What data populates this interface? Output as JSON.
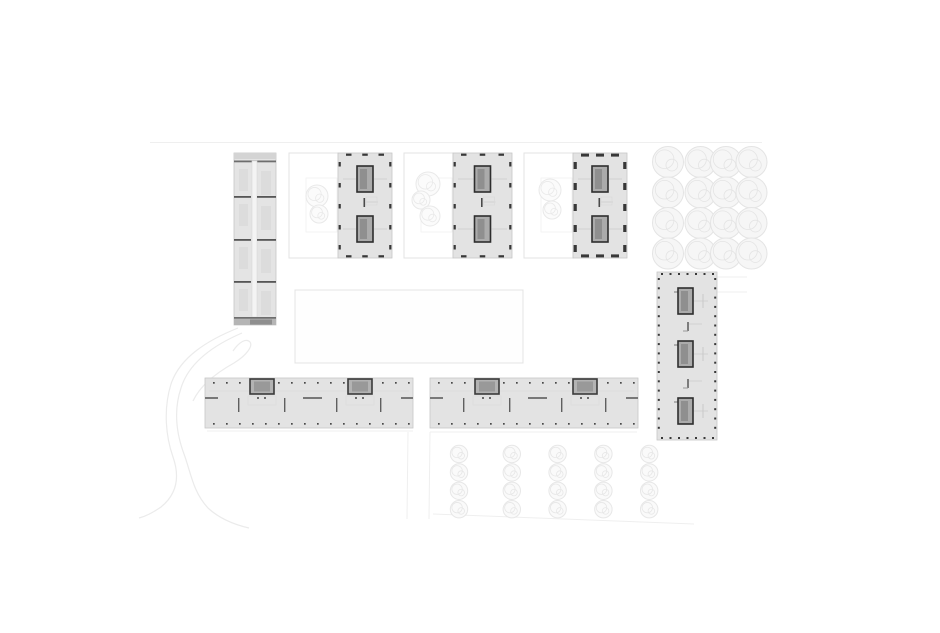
{
  "canvas": {
    "width": 940,
    "height": 633,
    "background": "#ffffff"
  },
  "palette": {
    "building_fill": "#e3e3e3",
    "building_stroke": "#c7c7c7",
    "slab_fill": "#e4e4e4",
    "core_fill": "#ababab",
    "core_shaft": "#8f8f8f",
    "core_stroke": "#2e2e2e",
    "tick_dark": "#383838",
    "divider_dark": "#565656",
    "faint_line": "#efefef",
    "walkway_stroke": "#ebebeb",
    "courtyard_stroke": "#e3e3e3",
    "courtyard_inner_stroke": "#f1f1f1",
    "tree_stroke_big": "#e4e4e4",
    "tree_fill_big": "#f6f6f6",
    "tree_stroke_small": "#e7e7e7",
    "tree_fill_small": "#fafafa",
    "detail_faint": "#cfcfcf",
    "dash_gray": "#787878",
    "stub_gray": "#5f5f5f"
  },
  "site_lines": [
    {
      "x1": 150,
      "y1": 142.5,
      "x2": 762,
      "y2": 142.5,
      "w": 1
    },
    {
      "x1": 207,
      "y1": 431,
      "x2": 413,
      "y2": 431,
      "w": 1
    },
    {
      "x1": 430,
      "y1": 432,
      "x2": 637,
      "y2": 432,
      "w": 1
    },
    {
      "x1": 408,
      "y1": 432,
      "x2": 407,
      "y2": 519,
      "w": 1
    },
    {
      "x1": 430,
      "y1": 432,
      "x2": 429,
      "y2": 519,
      "w": 1
    },
    {
      "x1": 433,
      "y1": 514,
      "x2": 694,
      "y2": 524,
      "w": 1
    },
    {
      "x1": 717,
      "y1": 277,
      "x2": 747,
      "y2": 277,
      "w": 1
    },
    {
      "x1": 717,
      "y1": 292,
      "x2": 747,
      "y2": 292,
      "w": 1
    }
  ],
  "walkway_paths": [
    "M238,328 C208,340 180,357 171,384 C163,410 166,437 173,457 C180,477 177,494 161,507 C151,514 143,517 139,518",
    "M242,333 C214,345 189,362 181,388 C173,412 177,435 184,454 C191,473 193,492 208,508 C221,520 236,525 249,528",
    "M233,351 C239,342 246,338 250,342 C253,346 247,355 234,363 C216,373 200,386 193,401"
  ],
  "lawn_rect": {
    "x": 295,
    "y": 290,
    "w": 228,
    "h": 73
  },
  "courtyards": [
    {
      "x": 289,
      "y": 153,
      "w": 49,
      "h": 105,
      "inner": {
        "x": 306,
        "y": 178,
        "w": 31,
        "h": 54
      },
      "trees": [
        {
          "cx": 317,
          "cy": 196,
          "r": 11
        },
        {
          "cx": 319,
          "cy": 214,
          "r": 9
        }
      ]
    },
    {
      "x": 404,
      "y": 153,
      "w": 49,
      "h": 105,
      "inner": {
        "x": 421,
        "y": 178,
        "w": 31,
        "h": 54
      },
      "trees": [
        {
          "cx": 428,
          "cy": 184,
          "r": 12
        },
        {
          "cx": 421,
          "cy": 200,
          "r": 9
        },
        {
          "cx": 430,
          "cy": 216,
          "r": 10
        }
      ]
    },
    {
      "x": 524,
      "y": 153,
      "w": 49,
      "h": 105,
      "inner": {
        "x": 541,
        "y": 178,
        "w": 31,
        "h": 54
      },
      "trees": [
        {
          "cx": 550,
          "cy": 190,
          "r": 11
        },
        {
          "cx": 552,
          "cy": 210,
          "r": 9
        }
      ]
    }
  ],
  "slab_building": {
    "x": 234,
    "y": 153,
    "w": 42,
    "h": 172,
    "top_strip_h": 6,
    "top_line_y": 160.5,
    "bottom_line_y": 317,
    "bottom_band_y": 319,
    "corridor": {
      "dx": 18,
      "w": 5
    },
    "dividers": [
      196,
      239,
      281
    ],
    "segment_tops": [
      163,
      198,
      241,
      283
    ]
  },
  "point_blocks": [
    {
      "x": 338,
      "y": 153,
      "w": 54,
      "h": 105,
      "heavy": false
    },
    {
      "x": 453,
      "y": 153,
      "w": 59,
      "h": 105,
      "heavy": false
    },
    {
      "x": 573,
      "y": 153,
      "w": 54,
      "h": 105,
      "heavy": true
    }
  ],
  "point_block_core": {
    "w": 16,
    "h": 26,
    "dy": [
      13,
      63
    ]
  },
  "tower": {
    "x": 657,
    "y": 272,
    "w": 60,
    "h": 168,
    "core_dx": 21,
    "core_w": 15,
    "core_h": 26,
    "core_ys": [
      288,
      341,
      398
    ],
    "mid_ys": [
      322,
      379
    ]
  },
  "long_blocks": [
    {
      "x": 205
    },
    {
      "x": 430
    }
  ],
  "long_block_spec": {
    "y": 378,
    "w": 208,
    "h": 50,
    "core_rel": [
      45,
      143
    ],
    "core_w": 24,
    "core_h": 15,
    "stub_rel": [
      33,
      79,
      131,
      175
    ],
    "dash_rel": [
      {
        "dx": 0,
        "w": 13
      },
      {
        "dx": 98,
        "w": 19
      },
      {
        "dx": 196,
        "w": 12
      }
    ],
    "dash_y": 397,
    "dot_top_y": 382,
    "dot_bot_y": 423
  },
  "tree_grids": [
    {
      "x0": 671,
      "y0": 164,
      "cols": 4,
      "rows": 4,
      "dx": 26.5,
      "dy": 29.5,
      "r": 15.5,
      "big": true
    },
    {
      "x0": 462,
      "y0": 456,
      "cols": 5,
      "rows": 4,
      "dx": 46.8,
      "dy": 17.4,
      "r": 8.7,
      "big": false
    }
  ]
}
